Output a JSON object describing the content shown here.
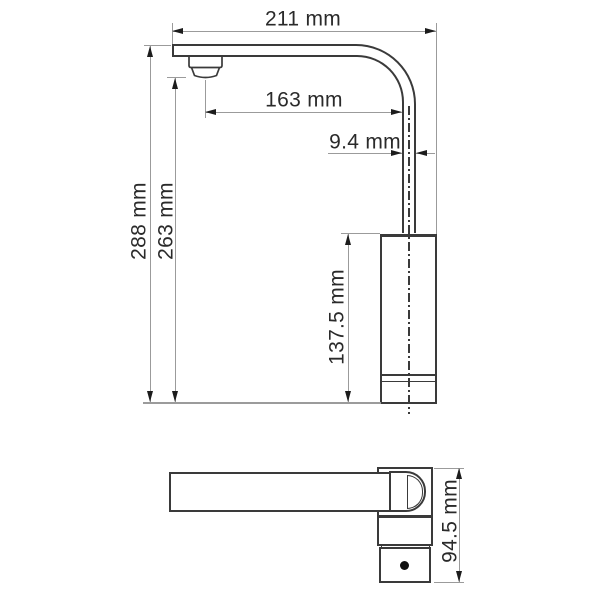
{
  "dimensions": {
    "total_reach": "211 mm",
    "spout_reach": "163 mm",
    "pipe_width": "9.4 mm",
    "total_height": "288 mm",
    "spout_height": "263 mm",
    "body_height": "137.5 mm",
    "side_view_height": "94.5 mm"
  },
  "colors": {
    "outline": "#3a3a3a",
    "dimension_line": "#9b9b9b",
    "arrow": "#1c1c1c",
    "text": "#2a2a2a",
    "background": "#ffffff"
  }
}
